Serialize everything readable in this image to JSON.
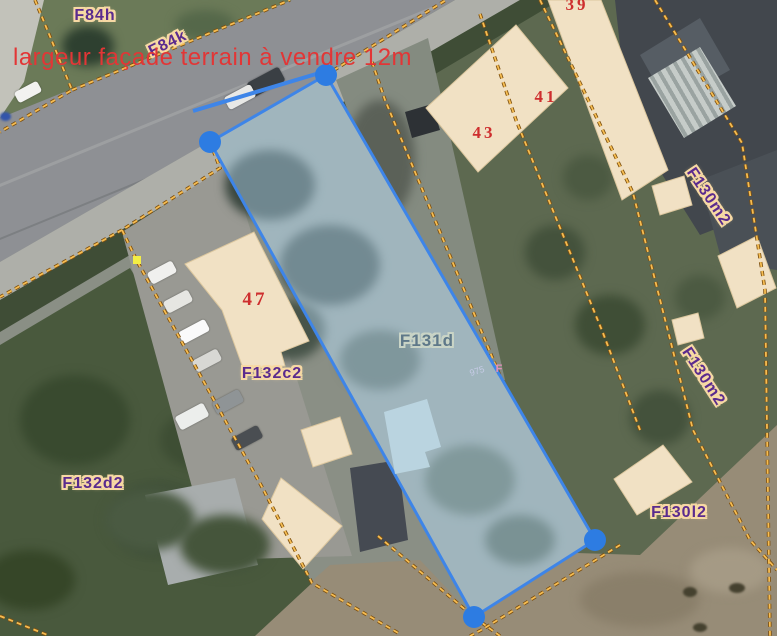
{
  "annotation": {
    "text": "largeur façade terrain à vendre 12m",
    "color": "#e23636"
  },
  "selected_parcel": {
    "label": "F131d",
    "fill_color": "#a5c8e0",
    "border_color": "#3e85e8",
    "vertex_color": "#2d7ce2",
    "vertex_count": 4
  },
  "parcel_labels": [
    {
      "text": "F84h"
    },
    {
      "text": "F84k"
    },
    {
      "text": "F130m2"
    },
    {
      "text": "F130m2"
    },
    {
      "text": "F130l2"
    },
    {
      "text": "F132c2"
    },
    {
      "text": "F132d2"
    }
  ],
  "house_numbers": [
    {
      "text": "39"
    },
    {
      "text": "41"
    },
    {
      "text": "43"
    },
    {
      "text": "47"
    }
  ],
  "small_annotation": {
    "text": "975",
    "suffix": "F"
  },
  "colors": {
    "cadastral_boundary": "#f6b84d",
    "parcel_label_purple": "#5a2b8e",
    "label_halo": "#f7d9a4",
    "house_number_red": "#ce2e2e",
    "building_footprint": "#f1e1c4",
    "selection_handle_blue": "#2d7ce2",
    "yellow_marker": "#f4ee44"
  }
}
